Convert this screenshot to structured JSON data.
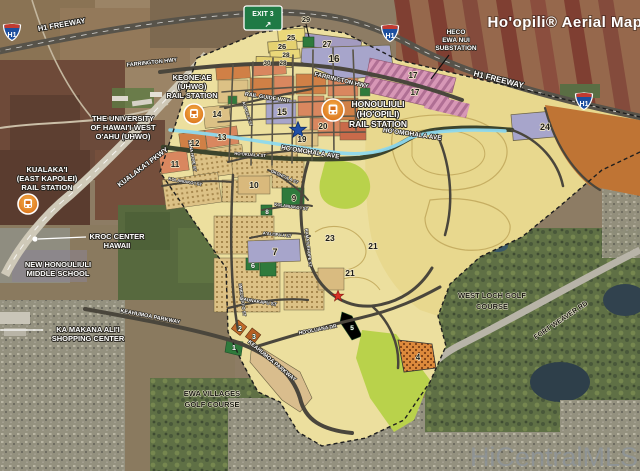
{
  "title_text": "Ho'opili® Aerial Map",
  "watermark": "HiCentralMLS",
  "signs": {
    "exit": "EXIT 3",
    "exit_arrow": "↗",
    "h1": "H1"
  },
  "colors": {
    "rail_line": "#8ed9ee",
    "station_icon": "#e07c1f",
    "plan_base": "#ecdf9e",
    "park_green": "#2f7a3c",
    "lime_park": "#b9d24b",
    "parcel_lavender": "#a7a5cb",
    "parcel_salmon": "#d9875f",
    "exit_sign_green": "#1f7a45"
  },
  "roads": {
    "h1_left": "H1 FREEWAY",
    "h1_right": "H1 FREEWAY",
    "farrington_left": "FARRINGTON HWY",
    "farrington_center": "FARRINGTON HWY",
    "kualakai_pkwy": "KUALAKA'I PKWY",
    "rail_guide_way": "RAIL GUIDE WAY",
    "hoomohala_center": "HO'OMOHALA AVE",
    "hoomohala_right": "HO'OMOHALA AVE",
    "aopuaa": "AOPUA'A ST",
    "nana_hope": "NANA HOPE ST",
    "hookuala": "HO'OKUALA ST",
    "okohiula": "OKOHI'ULA ST",
    "kolaniakoi_west": "KOLANIAKO'I ST",
    "kolaniakoi_east": "KOLANIAKO'I ST",
    "iwikuamoo": "IWIKUAMO'O ST",
    "aaliipaa": "A'ALI'IPA'A ST",
    "kamailehope": "KAMA'ILEHOPE ST",
    "maunakapu": "MAUNAKAPU ST",
    "keahumoa_west": "KEAHUMOA PARKWAY",
    "keahumoa_center": "KEAHUMOA PARKWAY",
    "hooluana": "HO'OLUANA DR",
    "fort_weaver": "FORT WEAVER RD"
  },
  "places": {
    "heco": [
      "HECO",
      "EWA NUI",
      "SUBSTATION"
    ],
    "keoneae": [
      "KEONE'AE",
      "(UHWO)",
      "RAIL STATION"
    ],
    "honouliuli": [
      "HONOULIULI",
      "(HO'OPILI)",
      "RAIL STATION"
    ],
    "uhwo": [
      "THE UNIVERSITY",
      "OF HAWAI'I-WEST",
      "O'AHU (UHWO)"
    ],
    "kualakai_station": [
      "KUALAKA'I",
      "(EAST KAPOLEI)",
      "RAIL STATION"
    ],
    "kroc": [
      "KROC CENTER",
      "HAWAII"
    ],
    "middle_school": [
      "NEW HONOULIULI",
      "MIDDLE SCHOOL"
    ],
    "ka_makana": [
      "KA MAKANA ALI'I",
      "SHOPPING CENTER"
    ],
    "ewa_villages": [
      "EWA VILLAGES",
      "GOLF COURSE"
    ],
    "west_loch": [
      "WEST LOCH GOLF",
      "COURSE"
    ]
  },
  "parcels": {
    "p29_callout": "29",
    "p25": "25",
    "p26": "26",
    "p28a": "28",
    "p30": "30",
    "p28b": "28",
    "p27": "27",
    "p16": "16",
    "p17a": "17",
    "p17b": "17",
    "p14": "14",
    "p15": "15",
    "p20": "20",
    "p19": "19",
    "p13": "13",
    "p12": "12",
    "p11": "11",
    "p10": "10",
    "p9": "9",
    "p8": "8",
    "p7": "7",
    "p6": "6",
    "p23": "23",
    "p21a": "21",
    "p21b": "21",
    "p24": "24",
    "p1": "1",
    "p2": "2",
    "p3": "3",
    "p5": "5",
    "p4": "4"
  }
}
